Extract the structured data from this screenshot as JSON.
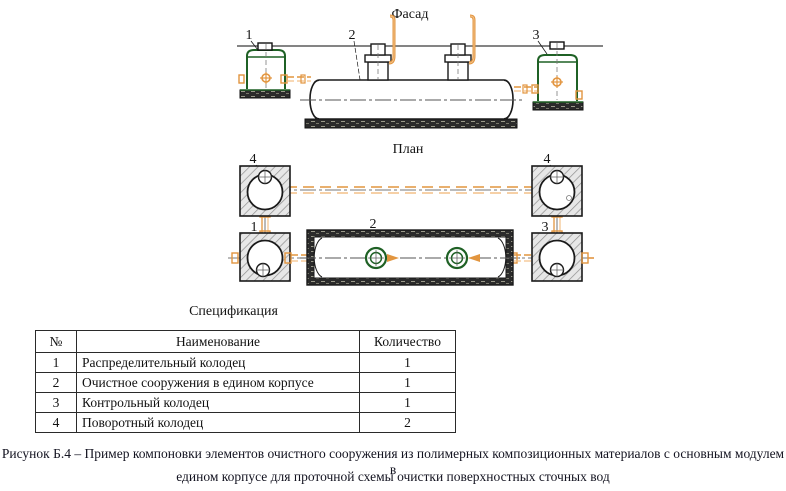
{
  "drawing": {
    "facade_label": "Фасад",
    "plan_label": "План",
    "callouts": {
      "c1": "1",
      "c2": "2",
      "c3": "3",
      "c4": "4"
    },
    "colors": {
      "green": "#1f6125",
      "orange": "#e2953f",
      "orange_light": "#f3c189",
      "dark": "#2b2b2b",
      "hatch_line": "#8f8f8f",
      "line": "#1a1a1a"
    }
  },
  "spec": {
    "title": "Спецификация",
    "headers": {
      "num": "№",
      "name": "Наименование",
      "qty": "Количество"
    },
    "rows": [
      {
        "num": "1",
        "name": "Распределительный колодец",
        "qty": "1"
      },
      {
        "num": "2",
        "name": "Очистное сооружения в едином корпусе",
        "qty": "1"
      },
      {
        "num": "3",
        "name": "Контрольный колодец",
        "qty": "1"
      },
      {
        "num": "4",
        "name": "Поворотный колодец",
        "qty": "2"
      }
    ]
  },
  "caption": {
    "line1": "Рисунок Б.4 – Пример компоновки элементов очистного сооружения из полимерных композиционных материалов с основным модулем в",
    "line2": "едином корпусе для проточной схемы очистки поверхностных сточных вод"
  }
}
